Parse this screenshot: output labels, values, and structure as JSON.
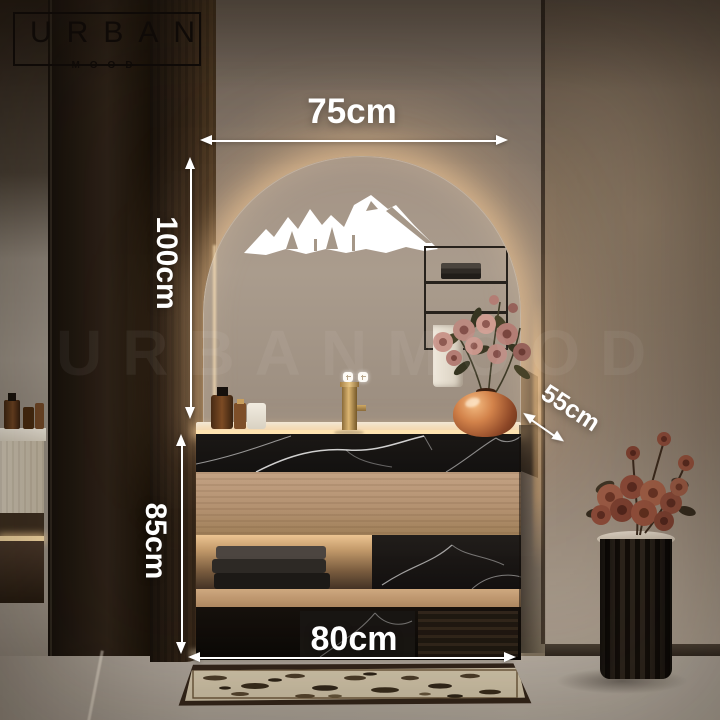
{
  "brand": {
    "logo_primary": "URBAN",
    "logo_secondary": "MOOD",
    "watermark": "URBANMOOD"
  },
  "annotations": {
    "mirror_width": "75cm",
    "mirror_height": "100cm",
    "vanity_depth": "55cm",
    "vanity_height": "85cm",
    "vanity_width": "80cm"
  },
  "scene": {
    "type": "product-photo",
    "subject": "Bathroom vanity with arched backlit LED mirror, black marble and oak cabinet, copper vase and fluted pedestal with roses",
    "icons": {
      "mirror_decal": "mountain-range",
      "mirror_controls": "touch-led-buttons"
    },
    "colors": {
      "dimension_text": "#ffffff",
      "led_glow": "#ffdca4",
      "marble_black": "#161312",
      "oak_wood": "#b4937a",
      "niche_wall": "#8f8175",
      "right_wall": "#7b6a5c",
      "copper_vase": "#b5663a"
    }
  }
}
